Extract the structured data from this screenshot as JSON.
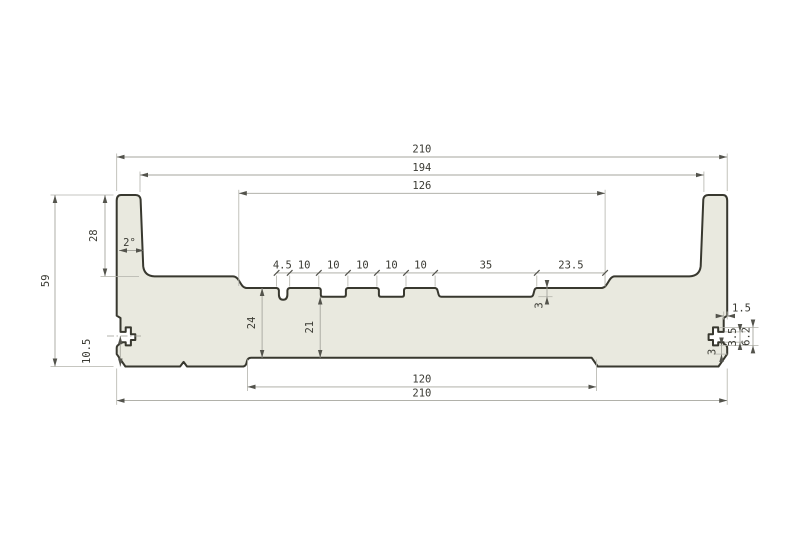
{
  "dims": {
    "top": [
      "210",
      "194",
      "126"
    ],
    "chain": [
      "4.5",
      "10",
      "10",
      "10",
      "10",
      "10",
      "35",
      "23.5"
    ],
    "bottom": [
      "120",
      "210"
    ],
    "left": {
      "total_height": "59",
      "flange_height": "28",
      "slot_center_from_bottom": "10.5",
      "draft_angle": "2°"
    },
    "middle": {
      "recess_to_bottom": "24",
      "groove_bottom_to_bottom": "21",
      "groove_depth": "3"
    },
    "right": {
      "edge_offset": "1.5",
      "slot_mouth_height": "3.5",
      "slot_cavity_height": "6.2",
      "bottom_wall": "3"
    }
  },
  "colors": {
    "profile_fill": "#e9e9df",
    "profile_outline": "#38382f",
    "dimension_lines": "#a6a69e",
    "dimension_text": "#3a3a33",
    "background": "#ffffff"
  }
}
